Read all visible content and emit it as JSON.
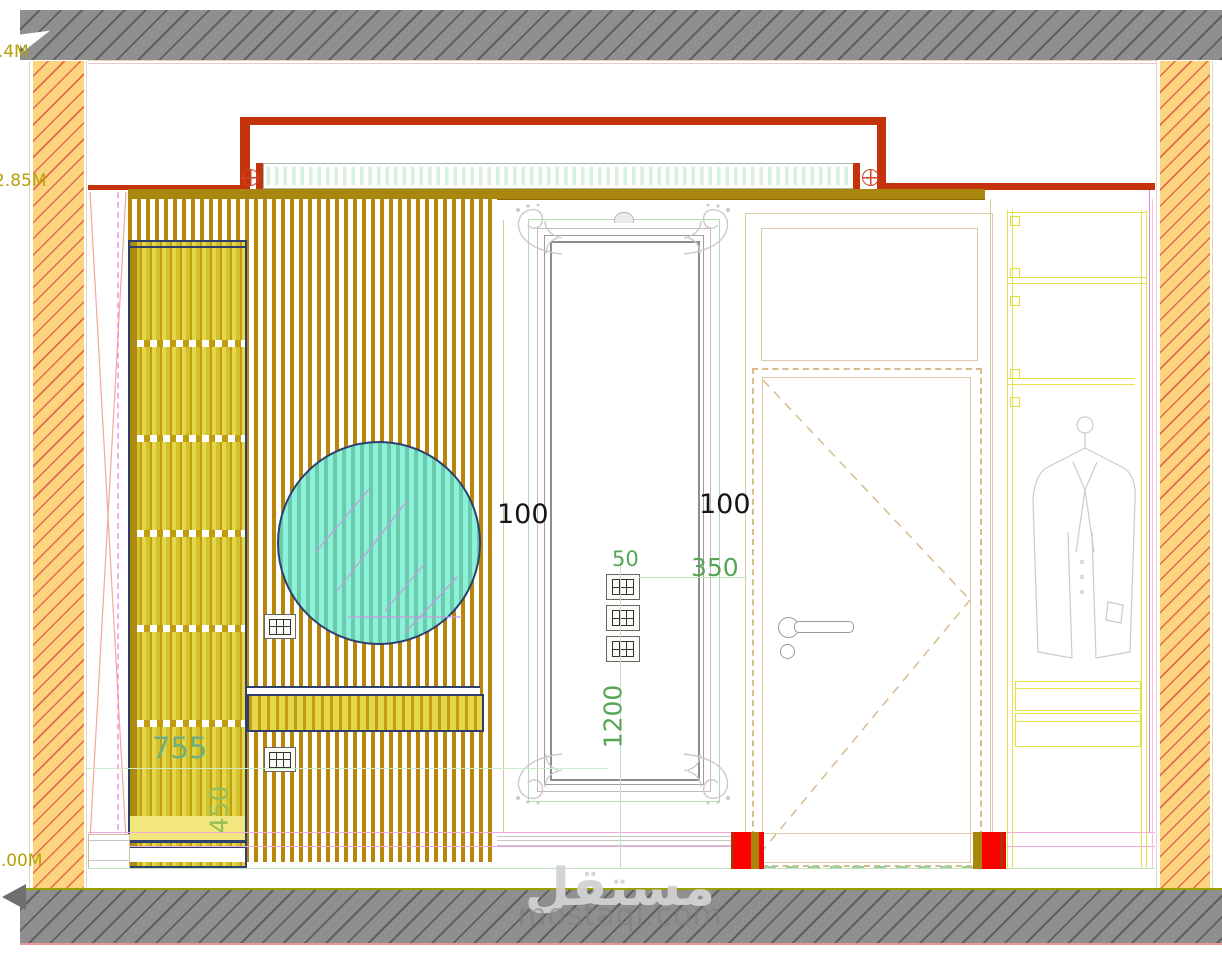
{
  "meta": {
    "type": "interior-elevation-drawing",
    "view": "bedroom wall elevation"
  },
  "levels": {
    "slab_top": "3.4M",
    "ceiling": "2.85M",
    "floor": "0.00M"
  },
  "dims": {
    "mirror_gap_left": "100",
    "mirror_gap_right": "100",
    "switch_size": "50",
    "switch_to_door": "350",
    "switch_height": "1200",
    "shelf_width": "755",
    "console_height": "450"
  },
  "watermark": {
    "arabic": "مستقل",
    "latin": "mostaql.com"
  },
  "colors": {
    "cornice_red": "#C5330C",
    "wall_fill": "#FCD47E",
    "wall_hatch": "#E06A50",
    "slat_wood": "#B8860B",
    "cabinet_yellow": "#E5D74D",
    "mirror_circle_teal": "#89F2D8",
    "outline_navy": "#2E3F6E",
    "dim_green": "#56A556",
    "jamb_red": "#FF0000",
    "slab_gray": "#8F8F8F"
  },
  "symbols": [
    "ceiling-rose",
    "wall-socket",
    "door-handle",
    "keyhole",
    "coat-hanger",
    "mirror-ornament"
  ]
}
